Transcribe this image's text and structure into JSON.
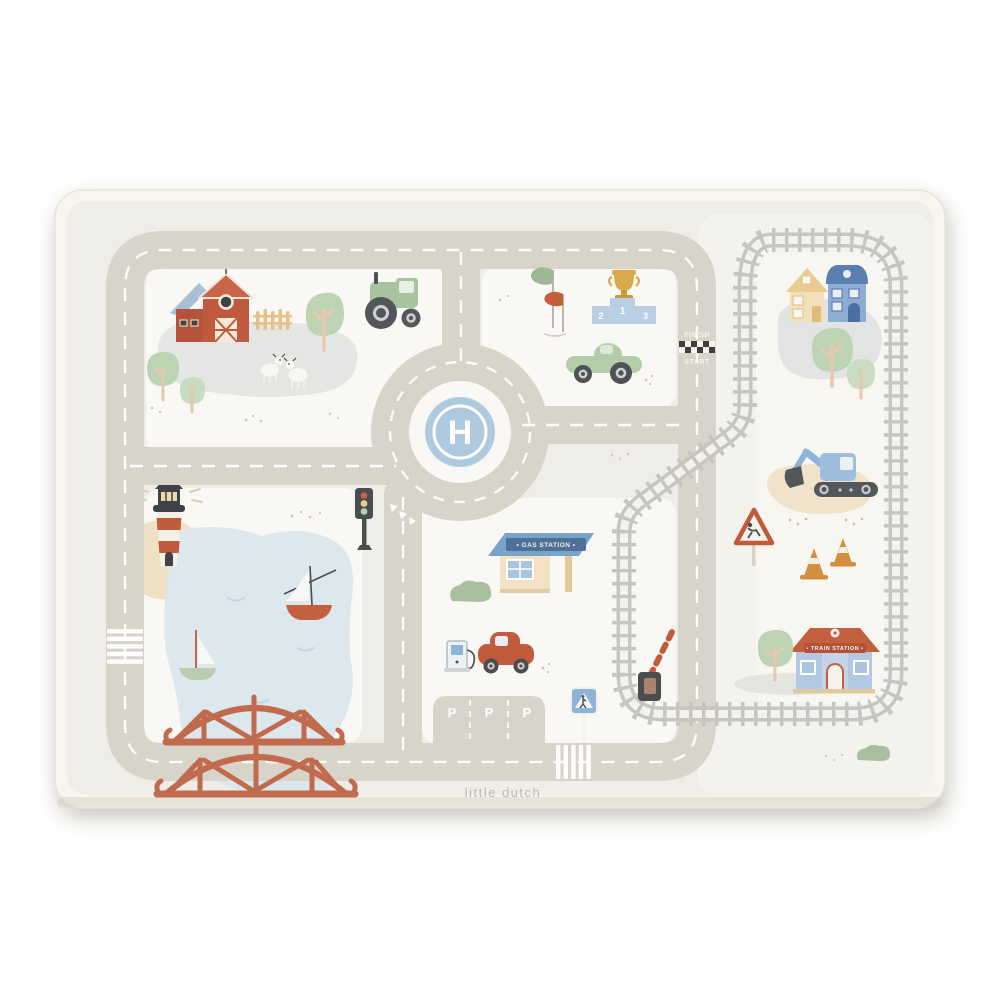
{
  "brand": {
    "wordmark": "little dutch"
  },
  "labels": {
    "helipad": "H",
    "finish": "FINISH",
    "start": "START",
    "podium_1": "1",
    "podium_2": "2",
    "podium_3": "3",
    "gas_station_sign": "• GAS STATION •",
    "train_station_sign": "• TRAIN STATION •",
    "parking": "P"
  },
  "colors": {
    "page_bg": "#ffffff",
    "mat_border": "#f7f5ee",
    "mat_bg": "#efede7",
    "section_bg": "#f9f8f4",
    "road": "#d8d4c9",
    "road_marking": "#ffffff",
    "railway": "#c6c5c0",
    "lake": "#dce8ee",
    "sand": "#efe1c6",
    "barn_red": "#c05a3e",
    "soft_blue": "#aecadf",
    "soft_green": "#b5ccab",
    "soft_yellow": "#e9c885",
    "dark_gray": "#4a4c4e",
    "cone_orange": "#d28f3f"
  },
  "scene": {
    "objects": [
      "play-mat",
      "barn",
      "goats",
      "tractor",
      "trees",
      "fence",
      "helipad-roundabout",
      "race-flags",
      "winners-podium",
      "trophy",
      "race-car",
      "finish-line",
      "houses",
      "railway-loop",
      "excavator",
      "traffic-cones",
      "roadworks-sign",
      "train-station",
      "lighthouse",
      "lake",
      "sailboats",
      "truss-bridge",
      "traffic-light",
      "gas-station",
      "fuel-pump",
      "red-car",
      "parking-lot",
      "pedestrian-crossing-sign",
      "railway-barrier",
      "zebra-crossing"
    ]
  }
}
